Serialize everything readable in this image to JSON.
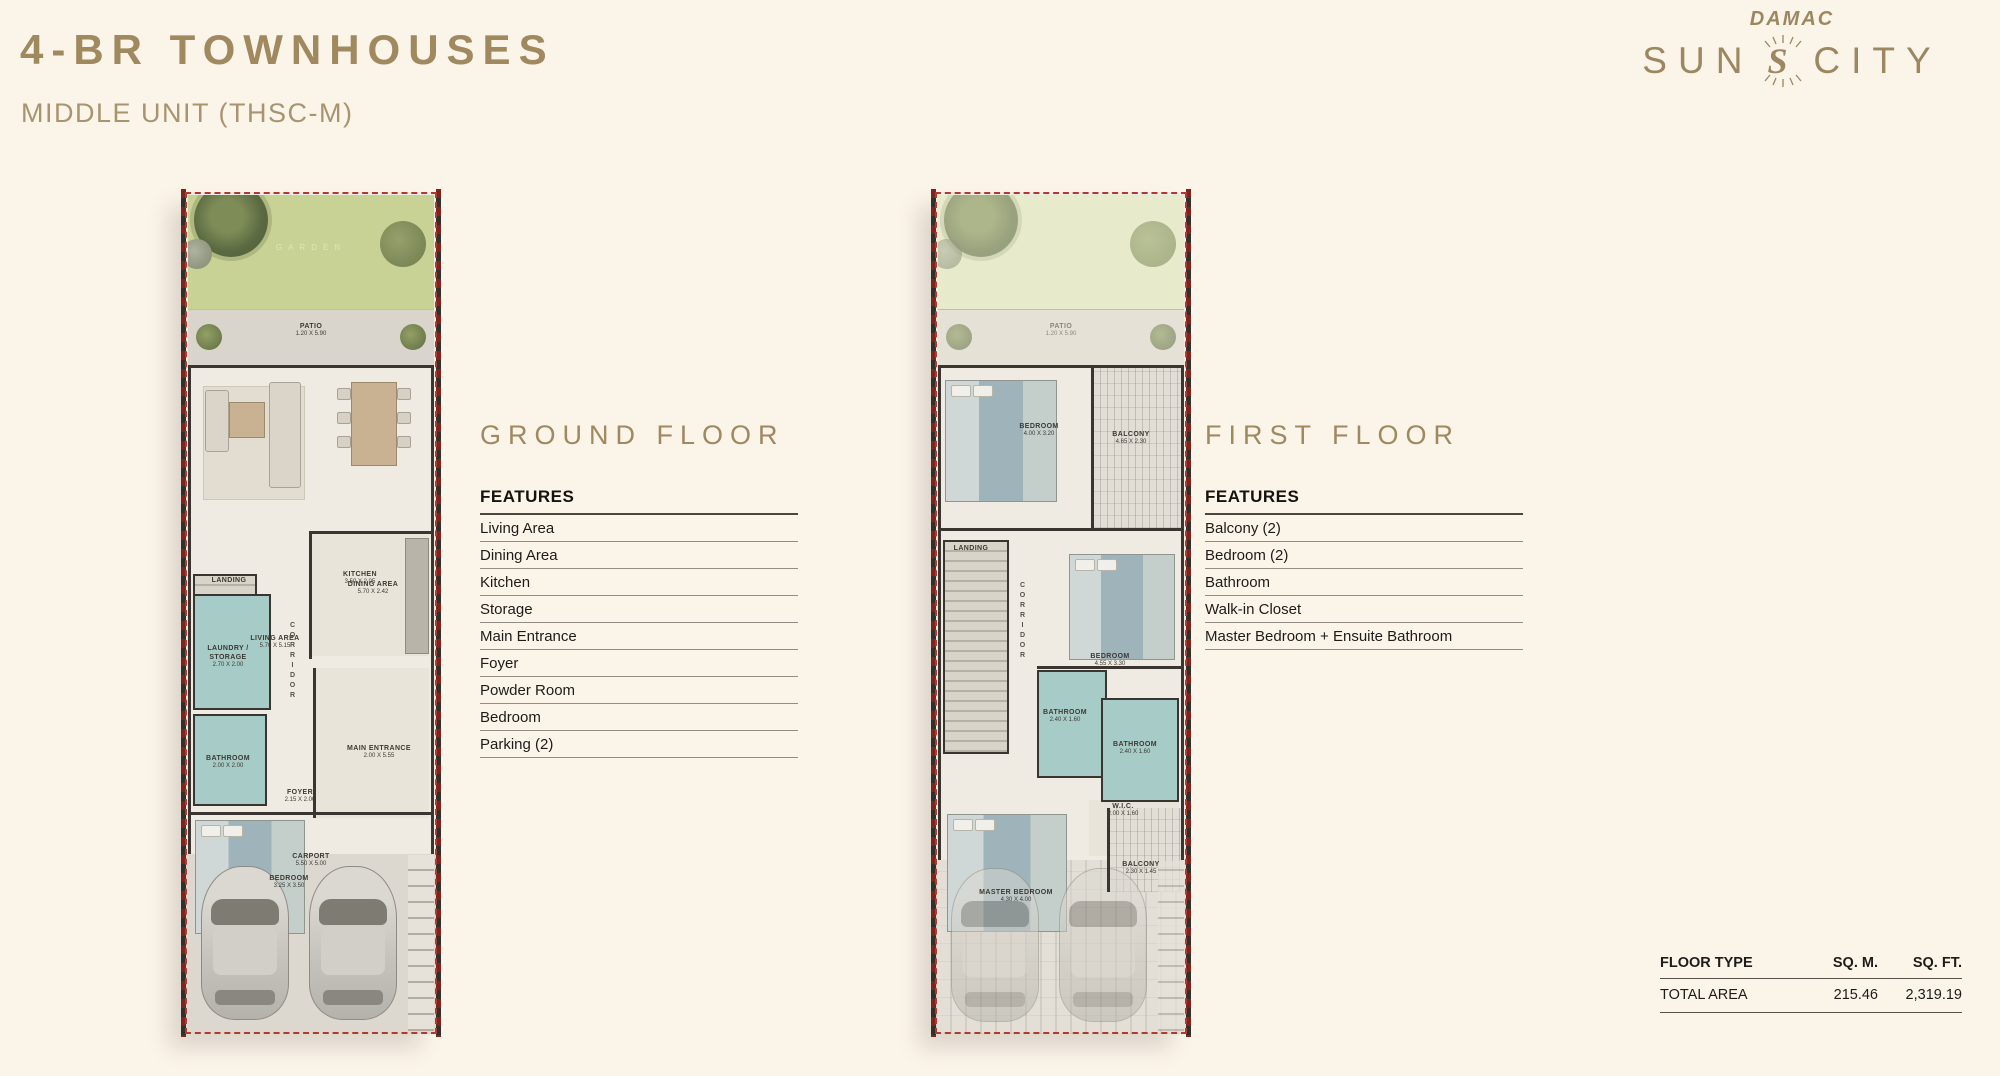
{
  "page": {
    "title": "4-BR TOWNHOUSES",
    "subtitle": "MIDDLE UNIT (THSC-M)"
  },
  "logo": {
    "brand": "DAMAC",
    "sun": "SUN",
    "city": "CITY"
  },
  "ground_floor": {
    "heading": "GROUND FLOOR",
    "features_title": "FEATURES",
    "features": [
      "Living Area",
      "Dining Area",
      "Kitchen",
      "Storage",
      "Main Entrance",
      "Foyer",
      "Powder Room",
      "Bedroom",
      "Parking (2)"
    ],
    "rooms": {
      "garden": {
        "name": "GARDEN"
      },
      "patio": {
        "name": "PATIO",
        "dim": "1.20 X 5.90"
      },
      "living": {
        "name": "LIVING AREA",
        "dim": "5.70 X 5.15"
      },
      "dining": {
        "name": "DINING AREA",
        "dim": "5.70 X 2.42"
      },
      "landing": {
        "name": "LANDING"
      },
      "kitchen": {
        "name": "KITCHEN",
        "dim": "3.50 X 2.05"
      },
      "laundry": {
        "name": "LAUNDRY / STORAGE",
        "dim": "2.70 X 2.00"
      },
      "corridor": {
        "name": "CORRIDOR"
      },
      "bathroom": {
        "name": "BATHROOM",
        "dim": "2.00 X 2.00"
      },
      "main_entrance": {
        "name": "MAIN ENTRANCE",
        "dim": "2.00 X 5.55"
      },
      "foyer": {
        "name": "FOYER",
        "dim": "2.15 X 2.00"
      },
      "bedroom": {
        "name": "BEDROOM",
        "dim": "3.25 X 3.50"
      },
      "carport": {
        "name": "CARPORT",
        "dim": "5.50 X 5.00"
      }
    }
  },
  "first_floor": {
    "heading": "FIRST FLOOR",
    "features_title": "FEATURES",
    "features": [
      "Balcony (2)",
      "Bedroom (2)",
      "Bathroom",
      "Walk-in Closet",
      "Master Bedroom + Ensuite Bathroom"
    ],
    "rooms": {
      "patio": {
        "name": "PATIO",
        "dim": "1.20 X 5.90"
      },
      "bedroom2": {
        "name": "BEDROOM",
        "dim": "4.00 X 3.20"
      },
      "balcony1": {
        "name": "BALCONY",
        "dim": "4.65 X 2.30"
      },
      "landing": {
        "name": "LANDING"
      },
      "corridor": {
        "name": "CORRIDOR"
      },
      "bedroom3": {
        "name": "BEDROOM",
        "dim": "4.55 X 3.30"
      },
      "bathroom1": {
        "name": "BATHROOM",
        "dim": "2.40 X 1.60"
      },
      "bathroom2": {
        "name": "BATHROOM",
        "dim": "2.40 X 1.60"
      },
      "wic": {
        "name": "W.I.C.",
        "dim": "2.00 X 1.60"
      },
      "master": {
        "name": "MASTER BEDROOM",
        "dim": "4.30 X 4.00"
      },
      "balcony2": {
        "name": "BALCONY",
        "dim": "2.30 X 1.45"
      }
    }
  },
  "area_table": {
    "headers": [
      "FLOOR TYPE",
      "SQ. M.",
      "SQ. FT."
    ],
    "row": {
      "label": "TOTAL AREA",
      "sqm": "215.46",
      "sqft": "2,319.19"
    }
  }
}
